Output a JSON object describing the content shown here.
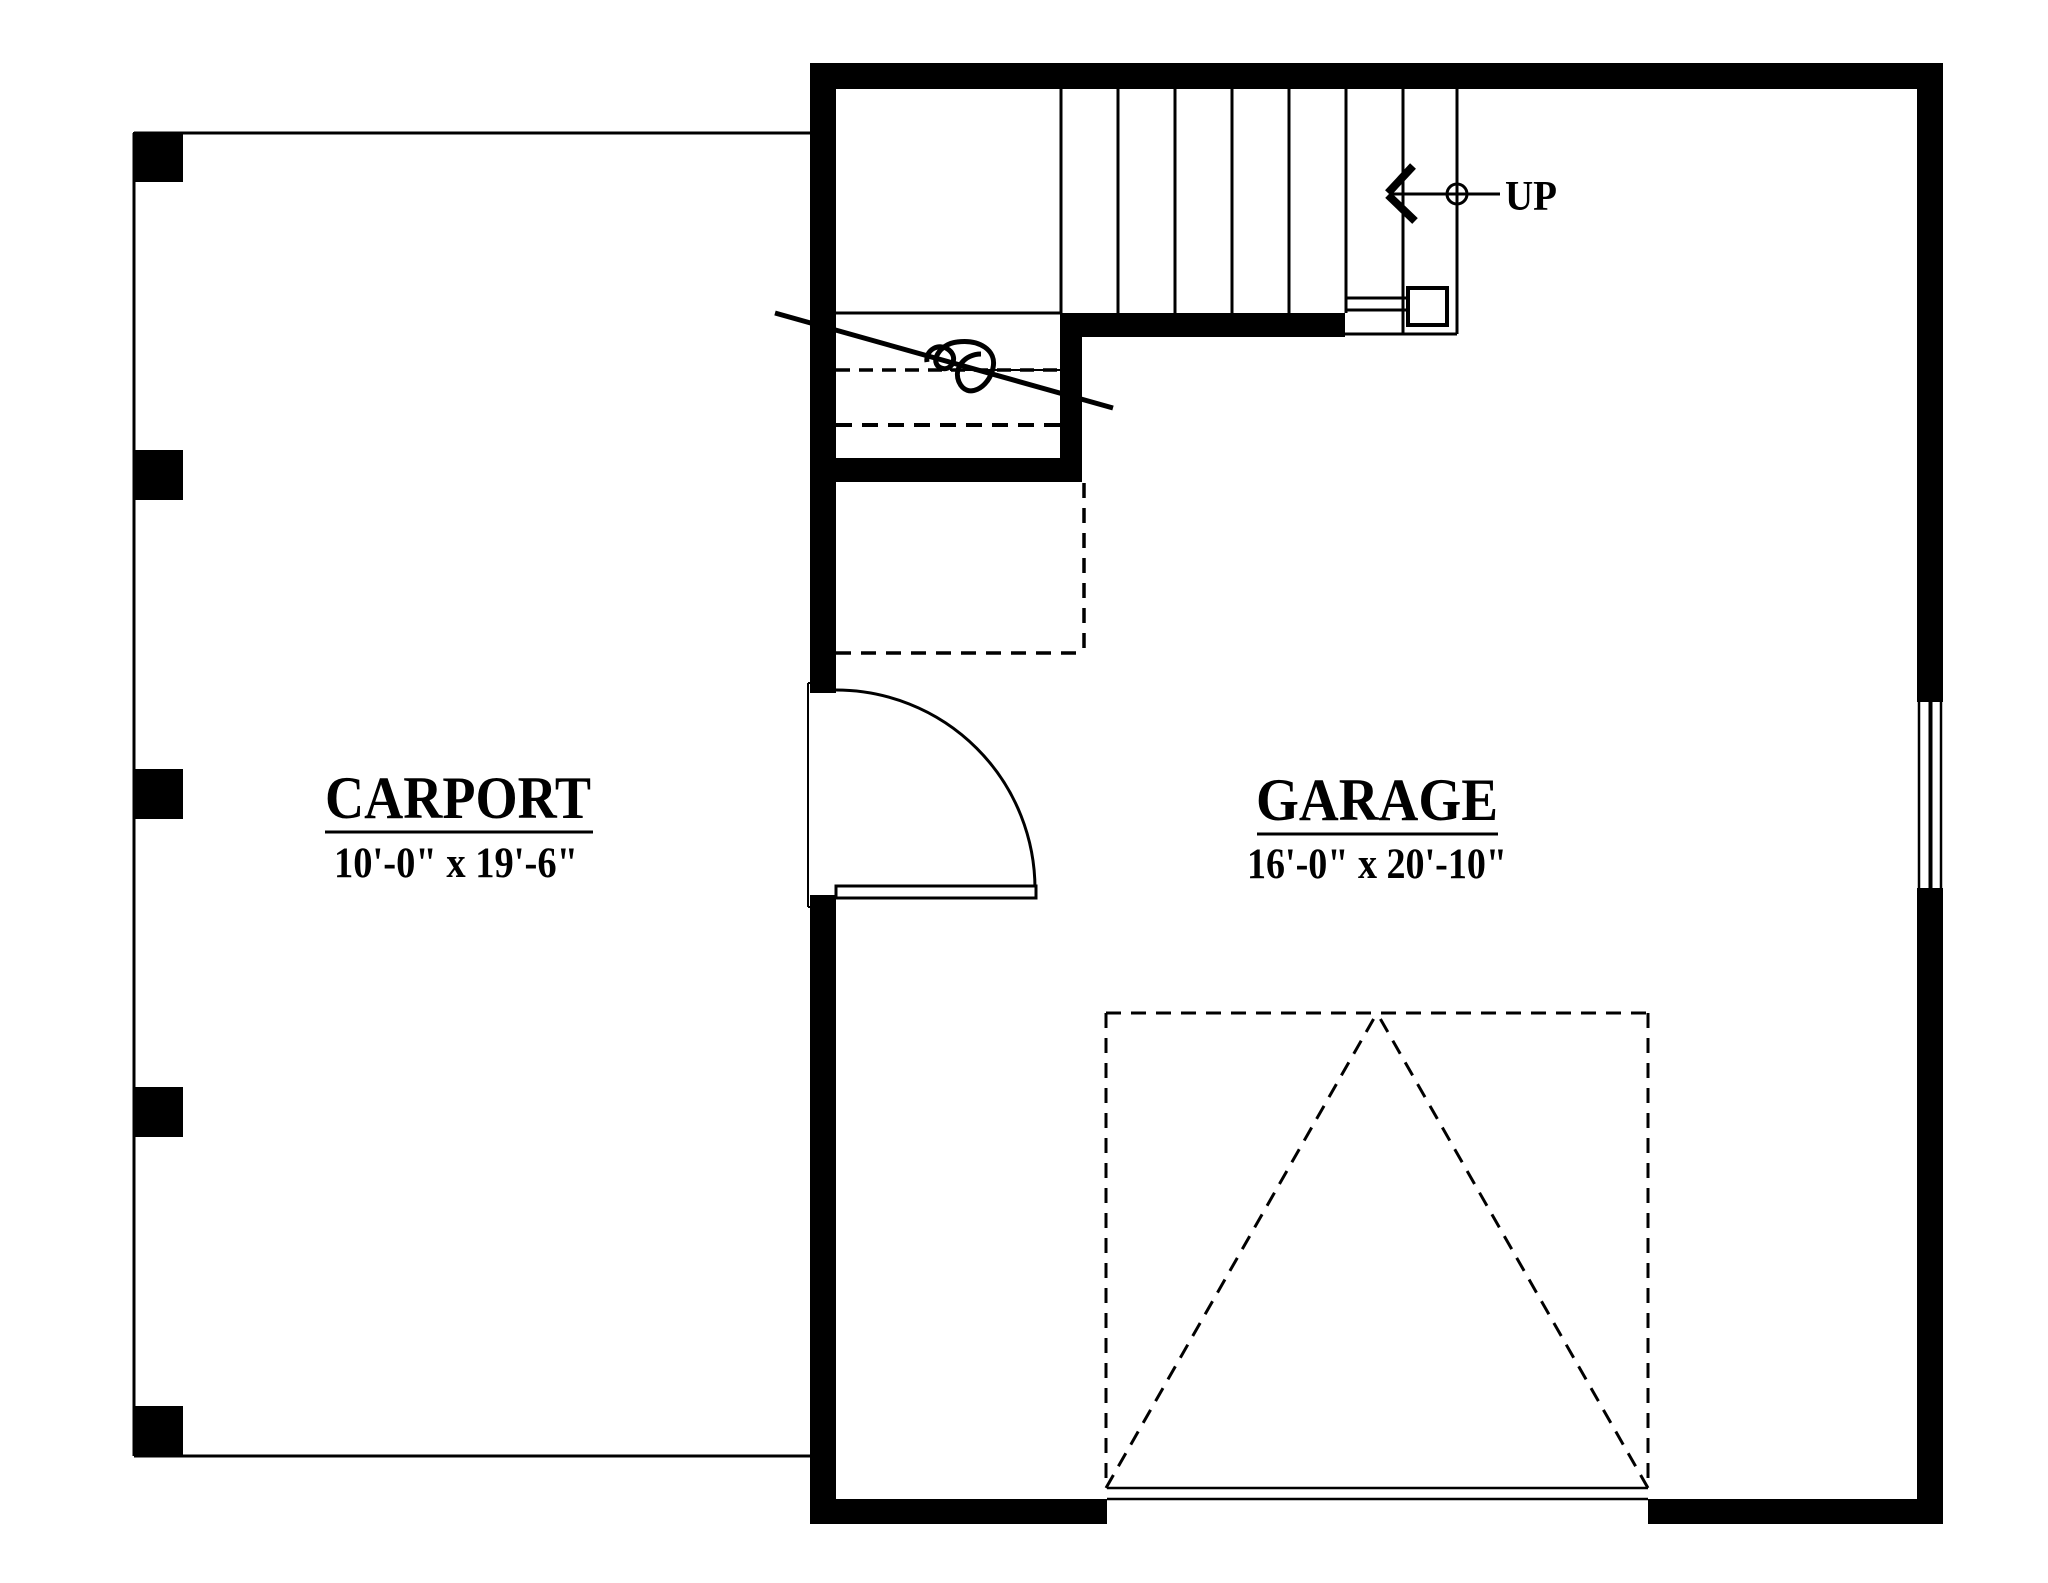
{
  "drawing": {
    "type": "floor-plan",
    "rooms": {
      "carport": {
        "label": "CARPORT",
        "dims": "10'-0\" x 19'-6\""
      },
      "garage": {
        "label": "GARAGE",
        "dims": "16'-0\" x 20'-10\""
      }
    },
    "stair": {
      "up_label": "UP",
      "tread_lines": 8
    },
    "colors": {
      "ink": "#000000",
      "paper": "#ffffff"
    }
  }
}
